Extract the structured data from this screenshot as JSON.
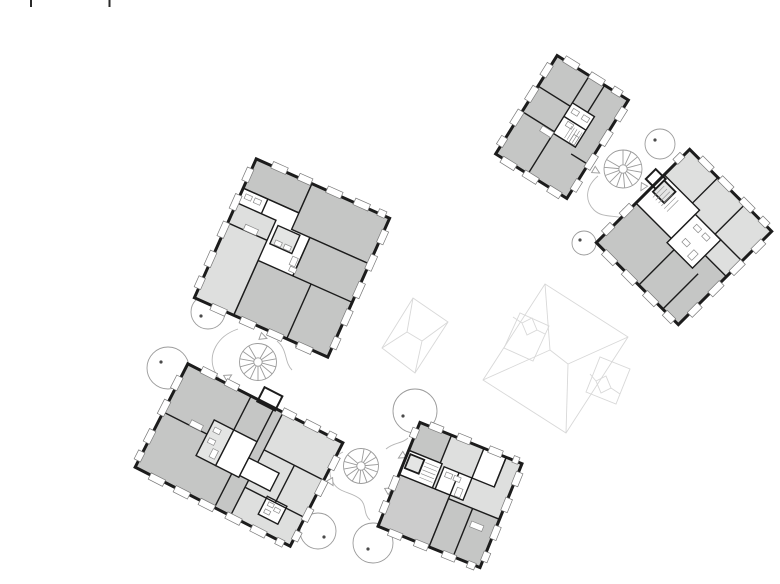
{
  "document": {
    "type": "architectural-site-plan",
    "description": "Site plan with ground-floor plans of five rotated apartment buildings, three external spiral staircases, tree circles and faint roof outlines of two further volumes"
  },
  "palette": {
    "background": "#ffffff",
    "wall": "#1c1c1c",
    "room_medium": "#c5c6c5",
    "room_light": "#dedfde",
    "room_soft": "#cccccc",
    "cell_light": "#e4e5e4",
    "window_stroke": "#787878",
    "fixture_stroke": "#8a8a8a",
    "site_line": "#9b9b9b",
    "tree_dot": "#4a4a4a",
    "faint_line": "#d8d8d8",
    "path_line": "#b6b6b6",
    "mark_line": "#2a2a2a"
  },
  "inventory": {
    "buildings": [
      {
        "id": "building-north-east",
        "scheme": "medium-gray rooms, white core cells"
      },
      {
        "id": "building-east",
        "scheme": "light-gray upper half, medium-gray lower half"
      },
      {
        "id": "building-west",
        "scheme": "medium-gray rooms with light-gray west wing"
      },
      {
        "id": "building-south-west",
        "scheme": "medium-gray west wing, light-gray east wing"
      },
      {
        "id": "building-south",
        "scheme": "light-gray rooms, medium-gray south rooms"
      }
    ],
    "spiral_staircases": 3,
    "trees": 7,
    "roof_outlines": 2,
    "registration_marks": 2
  }
}
